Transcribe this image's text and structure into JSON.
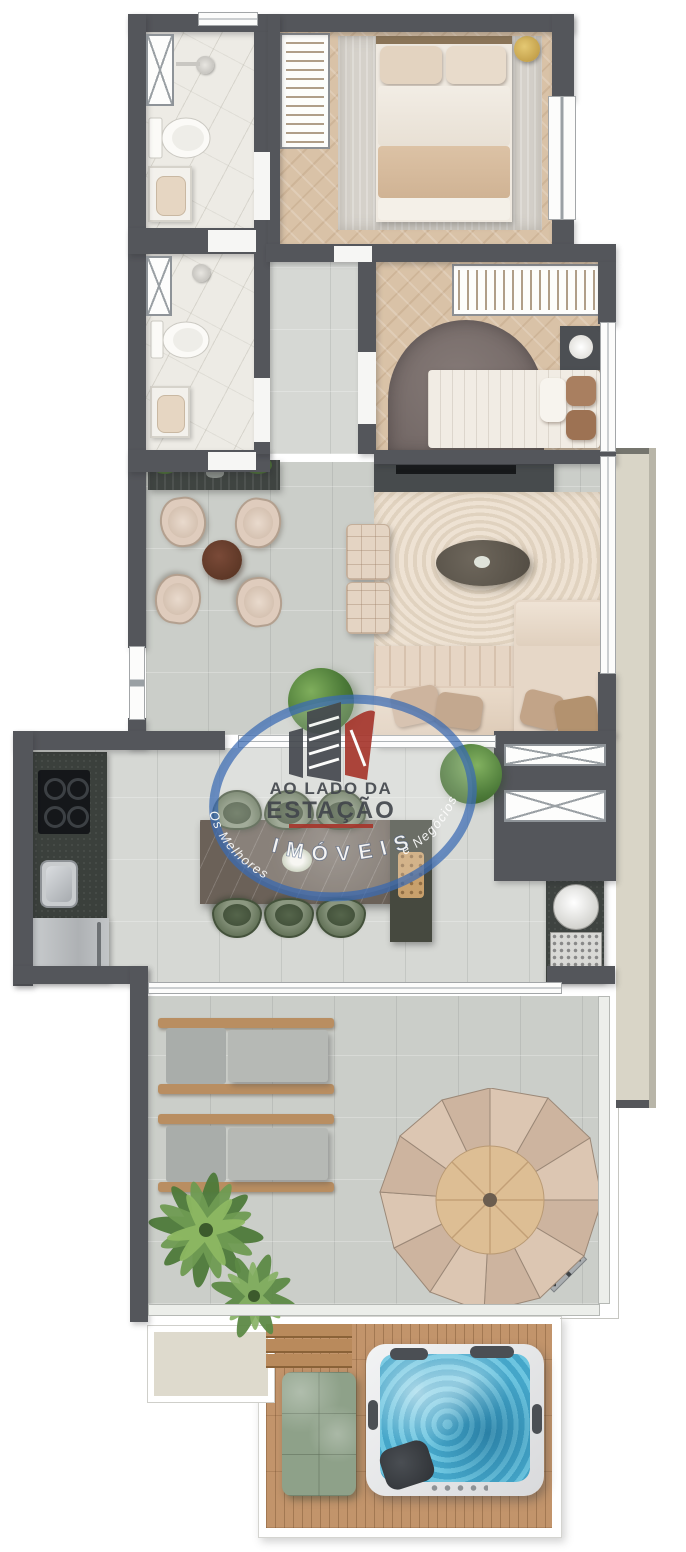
{
  "watermark": {
    "brand_top": "AO LADO DA",
    "brand_main": "ESTAÇÃO",
    "arc_bottom": "IMÓVEIS",
    "arc_left": "Os Melhores",
    "arc_right": "e Negócios"
  },
  "colors": {
    "background": "#ffffff",
    "wall": "#54565b",
    "tile_floor": "#cbcec9",
    "bathroom_marble": "#edebe5",
    "wood_floor": "#d9c2a7",
    "deck_wood": "#c2946b",
    "exterior_ledge": "#d9d5c7",
    "living_rug": "#ecdfd0",
    "sofa_beige": "#e0cdbb",
    "dining_chair": "#dfccbd",
    "kitchen_chair_green": "#66755b",
    "island_marble": "#6b6158",
    "counter_dark": "#3c403d",
    "hot_tub_water": "#55b6d8",
    "terrace_mattress_green": "#8ea189",
    "watermark_ring": "#3a6ab3",
    "watermark_text_dark": "#45494f",
    "watermark_accent_red": "#a8392f"
  },
  "rooms": [
    "bathroom-1",
    "bathroom-2",
    "master-bedroom",
    "corridor",
    "bedroom-2",
    "dining-area",
    "living-area",
    "kitchen",
    "terrace",
    "deck-spa"
  ]
}
